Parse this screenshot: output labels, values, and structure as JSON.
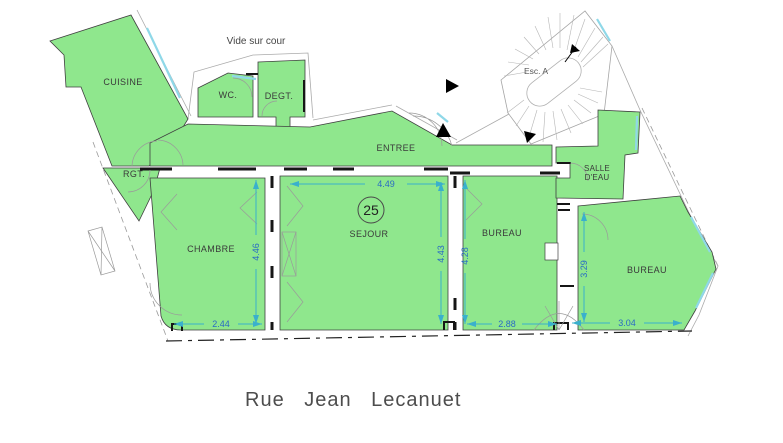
{
  "plan": {
    "courtyard_label": "Vide sur cour",
    "staircase_label": "Esc. A",
    "unit_number": "25",
    "street_name": "Rue  Jean  Lecanuet",
    "rooms": {
      "cuisine": "CUISINE",
      "wc": "WC.",
      "degt": "DEGT.",
      "rgt": "RGT.",
      "entree": "ENTREE",
      "chambre": "CHAMBRE",
      "sejour": "SEJOUR",
      "bureau_center": "BUREAU",
      "salle_deau_line1": "SALLE",
      "salle_deau_line2": "D'EAU",
      "bureau_right": "BUREAU"
    },
    "dimensions": {
      "sejour_width": "4.49",
      "chambre_depth": "4.46",
      "sejour_depth": "4.43",
      "bureau_center_depth": "4.28",
      "bureau_right_depth": "3.29",
      "chambre_width": "2.44",
      "bureau_center_width": "2.88",
      "bureau_right_width": "3.04"
    },
    "colors": {
      "room_fill": "#8fe78d",
      "dim_line": "#3ab0cc",
      "dim_text": "#2a6bc4",
      "label": "#3a3a3a",
      "street_text": "#4d4d4d",
      "window": "#8fd8e8"
    }
  }
}
